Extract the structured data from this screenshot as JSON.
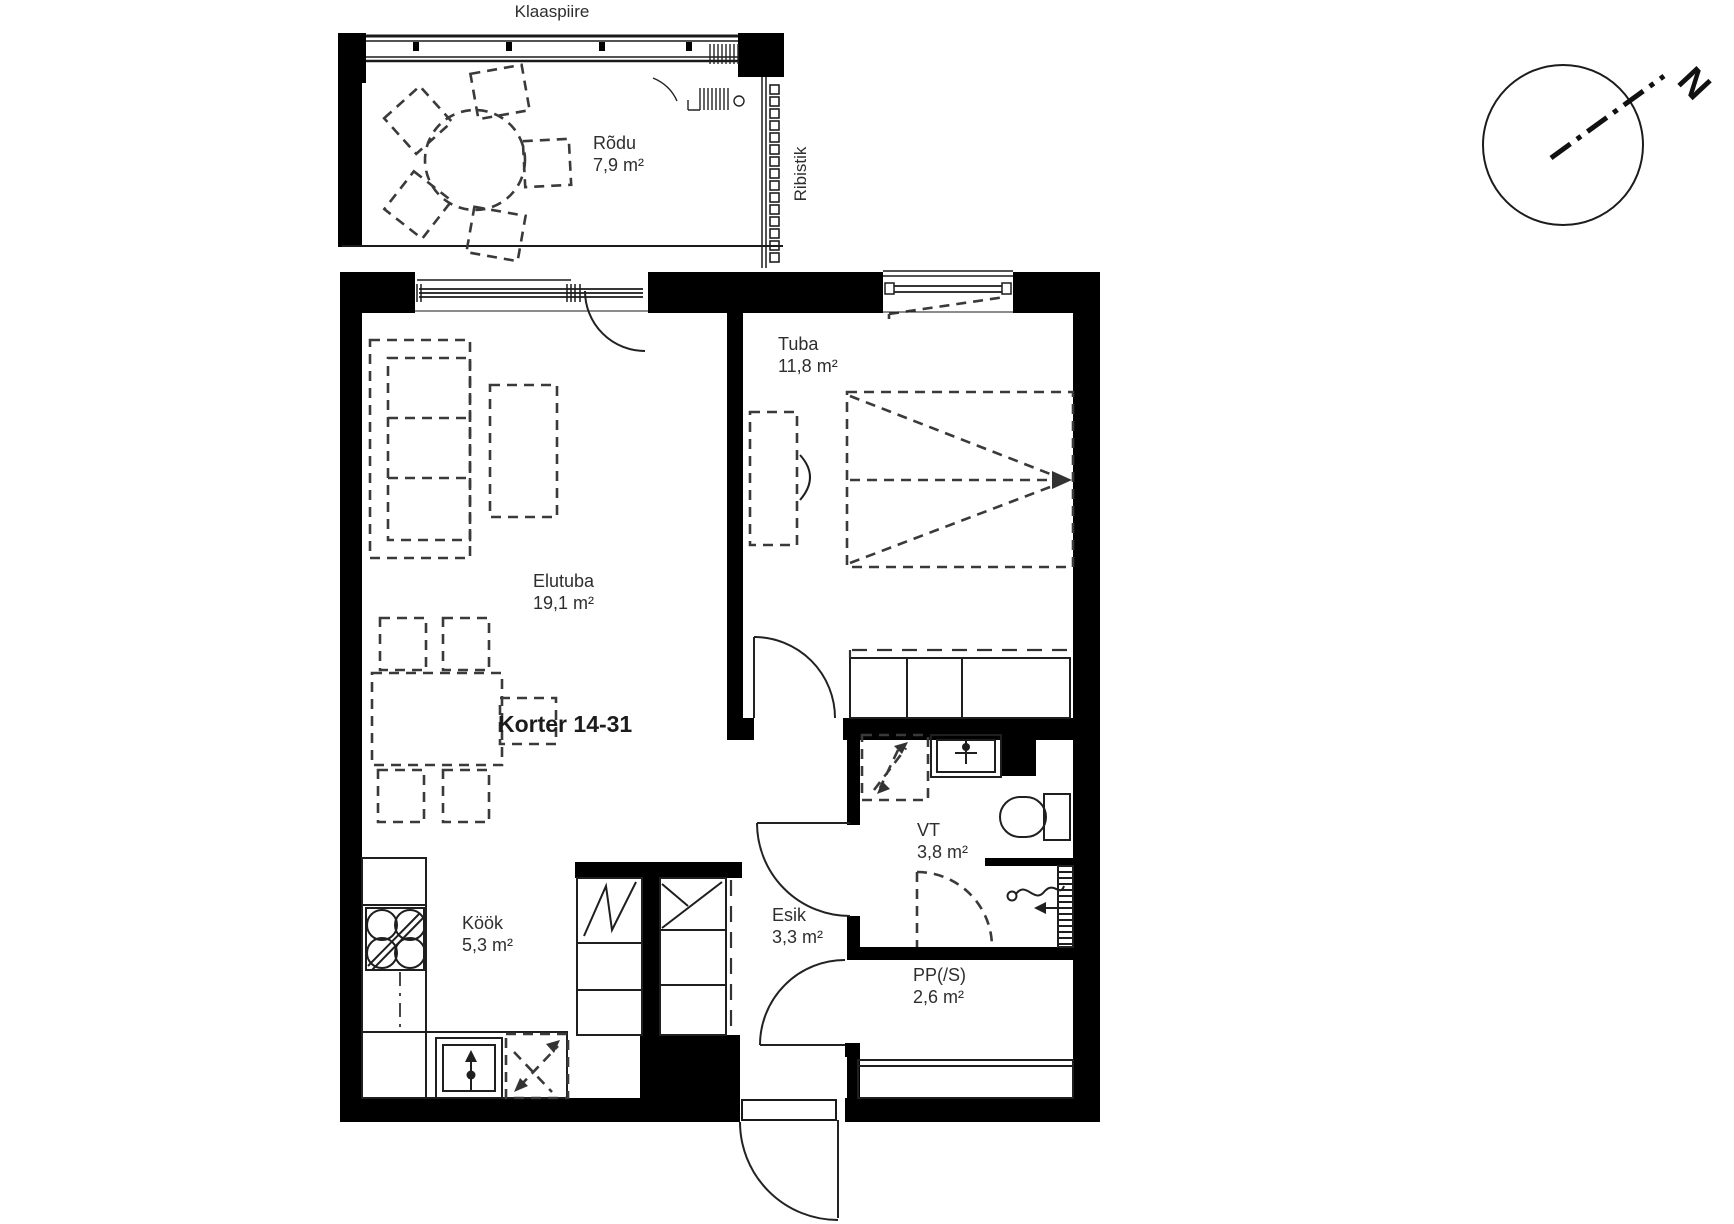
{
  "document": {
    "background": "#ffffff",
    "wall_color": "#000000",
    "line_color": "#2e2e2e",
    "title": "Korter 14-31"
  },
  "labels": {
    "glass_railing": "Klaaspiire",
    "louvre_screen": "Ribistik",
    "north": "N"
  },
  "rooms": {
    "rodu": {
      "name": "Rõdu",
      "area": "7,9 m²"
    },
    "elutuba": {
      "name": "Elutuba",
      "area": "19,1 m²"
    },
    "tuba": {
      "name": "Tuba",
      "area": "11,8 m²"
    },
    "kook": {
      "name": "Köök",
      "area": "5,3 m²"
    },
    "esik": {
      "name": "Esik",
      "area": "3,3 m²"
    },
    "vt": {
      "name": "VT",
      "area": "3,8 m²"
    },
    "pps": {
      "name": "PP(/S)",
      "area": "2,6 m²"
    }
  }
}
